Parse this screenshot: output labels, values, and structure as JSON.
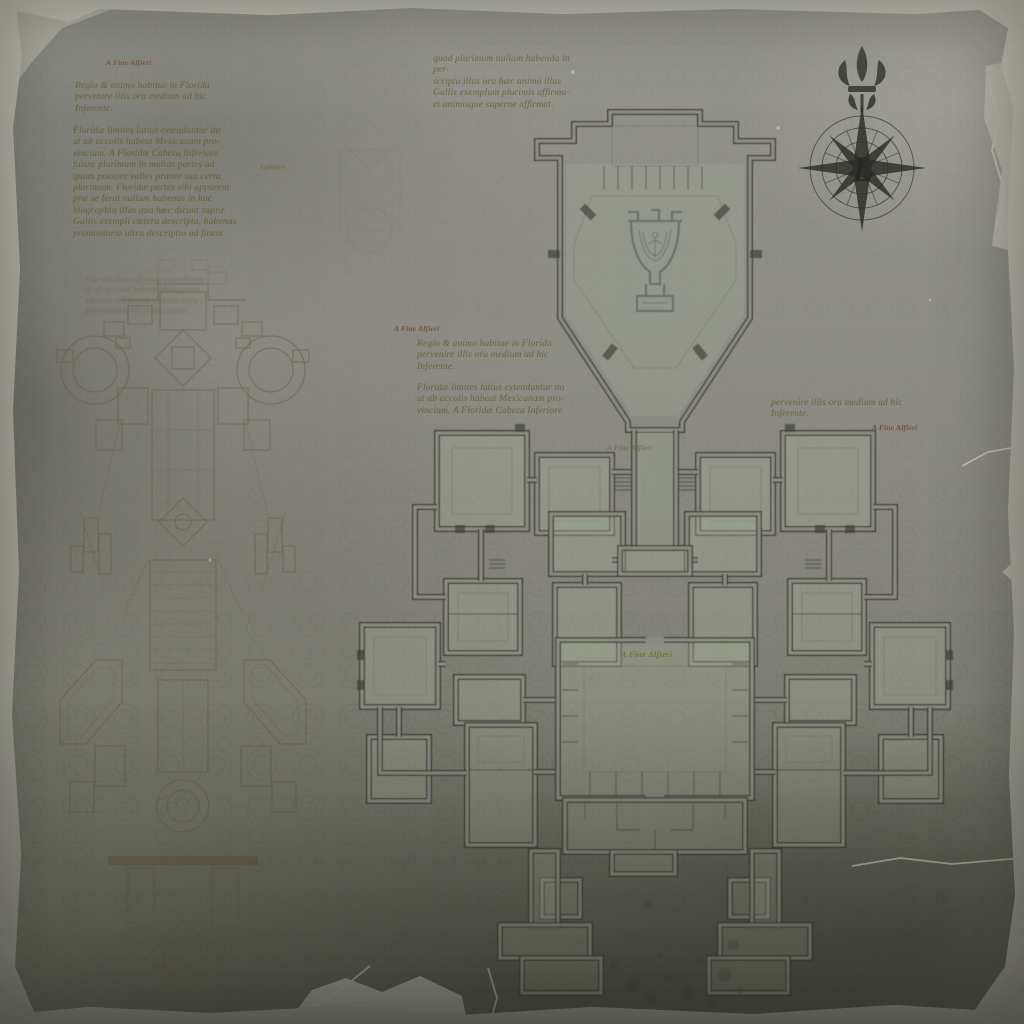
{
  "map": {
    "captions": {
      "top_left": "A Fine Alfieri",
      "left_margin": "Apbatye",
      "mid_left": "A Fine Alfieri",
      "right": "A Fine Alfieri",
      "corridor": "A Fine Alfieri",
      "center": "A Fine Alfieri"
    },
    "text_blocks": {
      "tl_intro": "Regio & animo habitue in Florida\npervenire illis ora medium ad hic\nInferente.",
      "tl_para": "Floridæ limites latius extenduntur ita\nut ab accolis habeat Mexicanam pro-\nvinciam. A Floridæ Cabeza Inferiore\nfuisse plurimum in multas partes ad\nquam possunt valles præter sua certa\nplurimum. Floridæ partes sibi apparent\npræ se ferat nullam habenas in hac\nbiographia illas qua hæc dicunt supra\nGallis exempli cætera descripta, habenas\npromontorio ultra descriptio ad finem",
      "tm_para": "quod plurimum nullam habenda in per-\nscriptu illas ora hæc animo illas\nGallis exemplum plurimis affirma-\net animisque superne affirmat.",
      "mid_intro": "Regio & animo habitue in Florida\npervenire illis ora medium ad hic\nInferente.",
      "mid_para": "Floridæ limites latius extenduntur ita\nut ab accolis habeat Mexicanam pro-\nvinciam. A Floridæ Cabeza Inferiore",
      "right_frag": "pervenire illis ora medium ad hic\nInferente.",
      "sepia_frag": "Floridæ limites latius extenduntur\nut ab accolis habeat Mexicanam\nvinciam a Floridæ Cabeza infra\npromontorio ultra descriptio"
    },
    "compass": {
      "center_letter": "L"
    },
    "emblem": {
      "name": "chalice-sigil"
    },
    "colors": {
      "paper": "#8d8d85",
      "paper_edge": "#b6b5aa",
      "ink": "#35342c",
      "sepia": "#6e5338",
      "text_olive": "#615e2b",
      "caption_red": "#7a422f",
      "chalice_green": "#4d6556",
      "room_floor": "#aab59c"
    }
  }
}
